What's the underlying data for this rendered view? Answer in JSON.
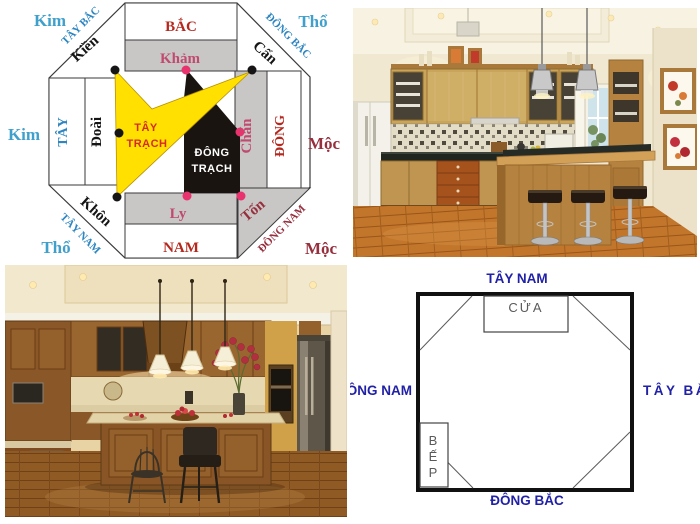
{
  "collage": {
    "bat_trach_diagram": {
      "corner_elements": {
        "top_left": "Kim",
        "top_right": "Thổ",
        "middle_left": "Kim",
        "middle_right": "Mộc",
        "bottom_left": "Thổ",
        "bottom_right": "Mộc"
      },
      "directions": {
        "north": "BẮC",
        "south": "NAM",
        "west": "TÂY",
        "east": "ĐÔNG",
        "northwest": "TÂY BẮC",
        "northeast": "ĐÔNG BẮC",
        "southwest": "TÂY NAM",
        "southeast": "ĐÔNG NAM"
      },
      "trigrams": {
        "northwest": "Kiền",
        "north": "Khảm",
        "northeast": "Cấn",
        "west": "Đoài",
        "east": "Chấn",
        "southwest": "Khôn",
        "south": "Ly",
        "southeast": "Tốn"
      },
      "house_groups": {
        "west_line1": "TÂY",
        "west_line2": "TRẠCH",
        "east_line1": "ĐÔNG",
        "east_line2": "TRẠCH"
      },
      "colors": {
        "direction_blue": "#2E86C1",
        "element_light_blue": "#3FA0CC",
        "direction_red": "#B5281E",
        "trigram_rose": "#C04A70",
        "element_maroon": "#96303E",
        "west_house_yellow": "#FFE000",
        "east_house_black": "#19140F",
        "dot_pink": "#E8336E",
        "band_gray": "#C9C7C5",
        "center_red": "#D42B1E"
      }
    },
    "floor_plan": {
      "direction_labels": {
        "top": "TÂY NAM",
        "bottom": "ĐÔNG BẮC",
        "left": "ĐÔNG NAM",
        "right": "TÂY BẮC"
      },
      "door_label": "CỬA",
      "stove_letters": [
        "B",
        "Ế",
        "P"
      ],
      "label_color": "#2121A8"
    }
  }
}
